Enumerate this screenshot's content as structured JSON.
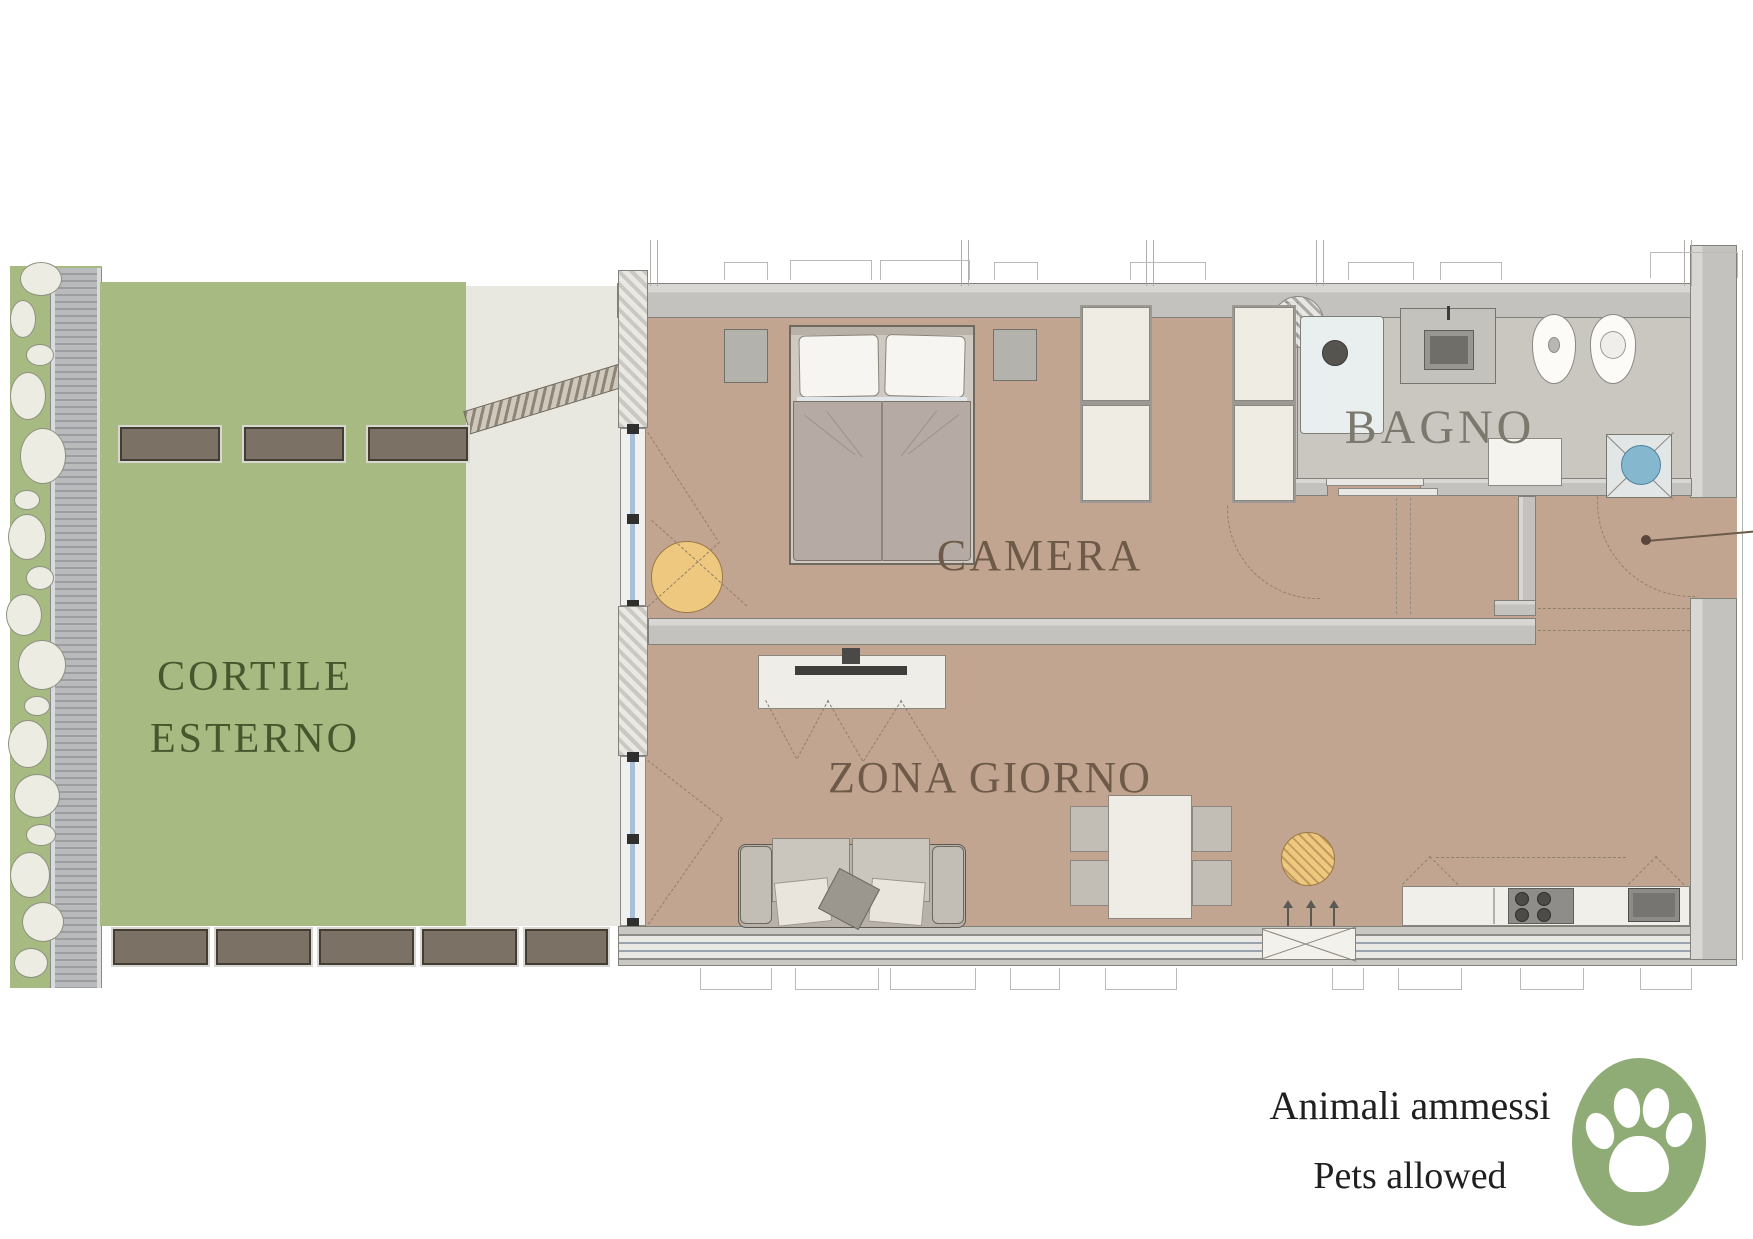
{
  "plan_title": "apartment-floor-plan",
  "labels": {
    "cortile_line1": "CORTILE",
    "cortile_line2": "ESTERNO",
    "camera": "CAMERA",
    "bagno": "BAGNO",
    "zona_giorno": "ZONA GIORNO"
  },
  "note": {
    "line1": "Animali ammessi",
    "line2": "Pets allowed"
  },
  "icons": {
    "pets_badge": "paw-icon"
  },
  "colors": {
    "lawn": "#a7ba81",
    "paved": "#e9e8e0",
    "floor": "#c2a591",
    "bagno-floor": "#c9c7c0",
    "planter": "#7b7265",
    "glazing": "#a9c0d8",
    "yellow": "#eec87e",
    "blue": "#85b7cf",
    "paw-green": "#8fac77",
    "label-green": "#46572e",
    "label-brown": "#6e5a49",
    "label-gray": "#7b786e",
    "dash": "#8f7f6e",
    "ink": "#1f1f1f"
  }
}
